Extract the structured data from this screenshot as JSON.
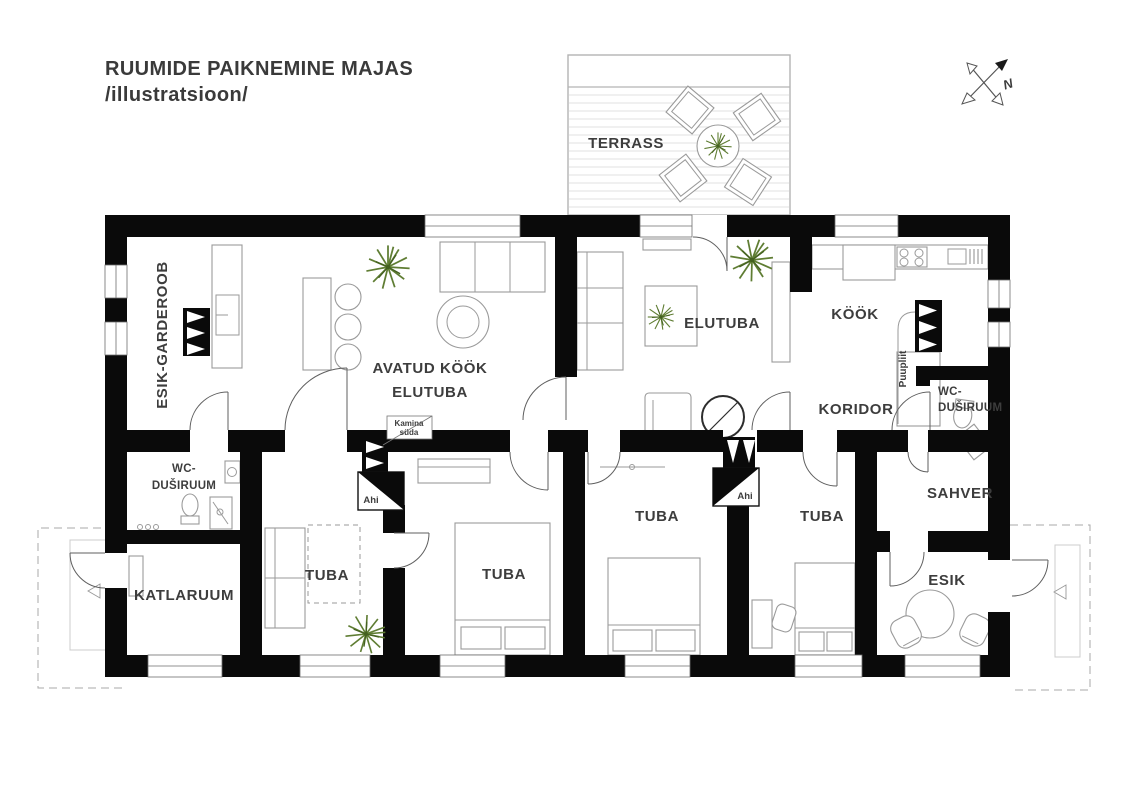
{
  "title": {
    "line1": "RUUMIDE PAIKNEMINE MAJAS",
    "line2": "/illustratsioon/"
  },
  "compass": {
    "north": "N"
  },
  "rooms": {
    "terrass": "TERRASS",
    "esik_garderoob": "ESIK-GARDEROOB",
    "avatud_kook_line1": "AVATUD KÖÖK",
    "avatud_kook_line2": "ELUTUBA",
    "elutuba": "ELUTUBA",
    "kook": "KÖÖK",
    "koridor": "KORIDOR",
    "wc_dusiruum_right_line1": "WC-",
    "wc_dusiruum_right_line2": "DUŠIRUUM",
    "sahver": "SAHVER",
    "wc_dusiruum_left_line1": "WC-",
    "wc_dusiruum_left_line2": "DUŠIRUUM",
    "katlaruum": "KATLARUUM",
    "tuba_1": "TUBA",
    "tuba_2": "TUBA",
    "tuba_3": "TUBA",
    "tuba_4": "TUBA",
    "esik": "ESIK"
  },
  "annotations": {
    "kamina_suda_line1": "Kamina",
    "kamina_suda_line2": "süda",
    "ahi_left": "Ahi",
    "ahi_right": "Ahi",
    "puupliit": "Puupliit"
  },
  "colors": {
    "wall": "#0a0a0a",
    "text": "#3d3d3d",
    "furniture_stroke": "#9a9a9a",
    "plant_green": "#5f7d33"
  }
}
